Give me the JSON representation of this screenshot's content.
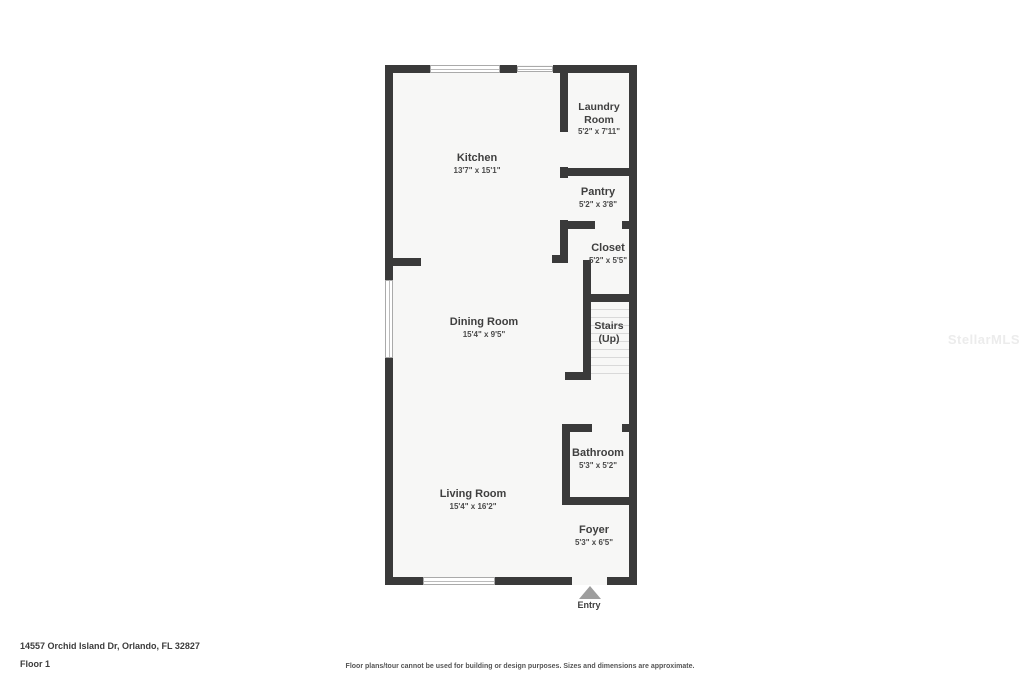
{
  "address_line": "14557 Orchid Island Dr, Orlando, FL 32827",
  "floor_label": "Floor 1",
  "disclaimer": "Floor plans/tour cannot be used for building or design purposes. Sizes and dimensions are approximate.",
  "watermark": "StellarMLS",
  "entry": {
    "label": "Entry"
  },
  "rooms": {
    "kitchen": {
      "name": "Kitchen",
      "dimensions": "13'7\" x 15'1\""
    },
    "laundry": {
      "name_line1": "Laundry",
      "name_line2": "Room",
      "dimensions": "5'2\" x 7'11\""
    },
    "pantry": {
      "name": "Pantry",
      "dimensions": "5'2\" x 3'8\""
    },
    "closet": {
      "name": "Closet",
      "dimensions": "5'2\" x 5'5\""
    },
    "dining": {
      "name": "Dining Room",
      "dimensions": "15'4\" x 9'5\""
    },
    "stairs": {
      "name_line1": "Stairs",
      "name_line2": "(Up)"
    },
    "bathroom": {
      "name": "Bathroom",
      "dimensions": "5'3\" x 5'2\""
    },
    "living": {
      "name": "Living Room",
      "dimensions": "15'4\" x 16'2\""
    },
    "foyer": {
      "name": "Foyer",
      "dimensions": "5'3\" x 6'5\""
    }
  },
  "colors": {
    "wall": "#3a3a3a",
    "floor_fill": "#f7f7f6",
    "stair_tread": "#d9d9d9",
    "entry_arrow": "#9e9e9e",
    "label_text": "#3f3f3f",
    "watermark_text": "#ececec"
  }
}
